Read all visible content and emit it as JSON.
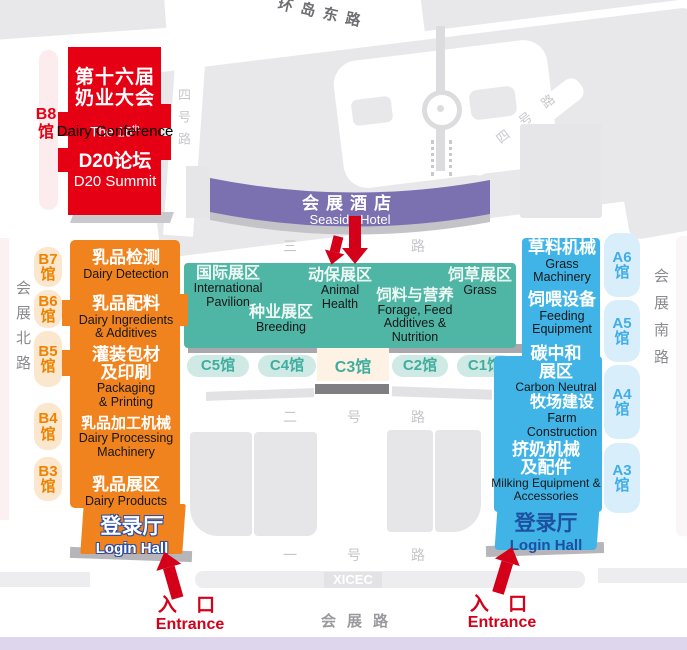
{
  "colors": {
    "red": "#e60013",
    "orange": "#f0831e",
    "teal": "#4fb5a4",
    "blue": "#41b4e7",
    "purple": "#7b70b0",
    "arrow_red": "#d40019"
  },
  "conference": {
    "hall_label": "B8\n馆",
    "line1_zh": "第十六届",
    "line2_zh": "奶业大会",
    "en_pre": "The 16",
    "en_sup": "th",
    "en_name": "Dairy Conference",
    "summit_zh": "D20论坛",
    "summit_en": "D20 Summit"
  },
  "hotel": {
    "zh": "会展酒店",
    "en": "Seaside Hotel"
  },
  "center": {
    "zones": [
      {
        "zh": "国际展区",
        "en": "International\nPavilion"
      },
      {
        "zh": "动保展区",
        "en": "Animal\nHealth"
      },
      {
        "zh": "饲草展区",
        "en": "Grass"
      },
      {
        "zh": "种业展区",
        "en": "Breeding"
      },
      {
        "zh": "饲料与营养",
        "en": "Forage, Feed\nAdditives &\nNutrition"
      }
    ],
    "halls": [
      "C5馆",
      "C4馆",
      "C3馆",
      "C2馆",
      "C1馆"
    ]
  },
  "west": {
    "sections": [
      {
        "zh": "乳品检测",
        "en": "Dairy Detection"
      },
      {
        "zh": "乳品配料",
        "en": "Dairy Ingredients\n& Additives"
      },
      {
        "zh": "灌装包材\n及印刷",
        "en": "Packaging\n& Printing"
      },
      {
        "zh": "乳品加工机械",
        "en": "Dairy Processing\nMachinery"
      },
      {
        "zh": "乳品展区",
        "en": "Dairy Products"
      }
    ],
    "login": {
      "zh": "登录厅",
      "en": "Login Hall"
    },
    "halls": [
      "B7\n馆",
      "B6\n馆",
      "B5\n馆",
      "B4\n馆",
      "B3\n馆"
    ]
  },
  "east": {
    "sections": [
      {
        "zh": "草料机械",
        "en": "Grass\nMachinery"
      },
      {
        "zh": "饲喂设备",
        "en": "Feeding\nEquipment"
      },
      {
        "zh": "碳中和\n展区",
        "en": "Carbon Neutral"
      },
      {
        "zh": "牧场建设",
        "en": "Farm\nConstruction"
      },
      {
        "zh": "挤奶机械\n及配件",
        "en": "Milking Equipment &\nAccessories"
      }
    ],
    "login": {
      "zh": "登录厅",
      "en": "Login Hall"
    },
    "halls": [
      "A6\n馆",
      "A5\n馆",
      "A4\n馆",
      "A3\n馆"
    ]
  },
  "roads": {
    "north": "环岛东路",
    "no4_west": "四号路",
    "no4_east": "四 号 路",
    "no3": "三号路",
    "no2": "二号路",
    "no1": "一号路",
    "west_side": "会展北路",
    "east_side": "会展南路",
    "south": "会展路",
    "venue": "XICEC"
  },
  "entrances": {
    "zh": "入 口",
    "en": "Entrance"
  }
}
